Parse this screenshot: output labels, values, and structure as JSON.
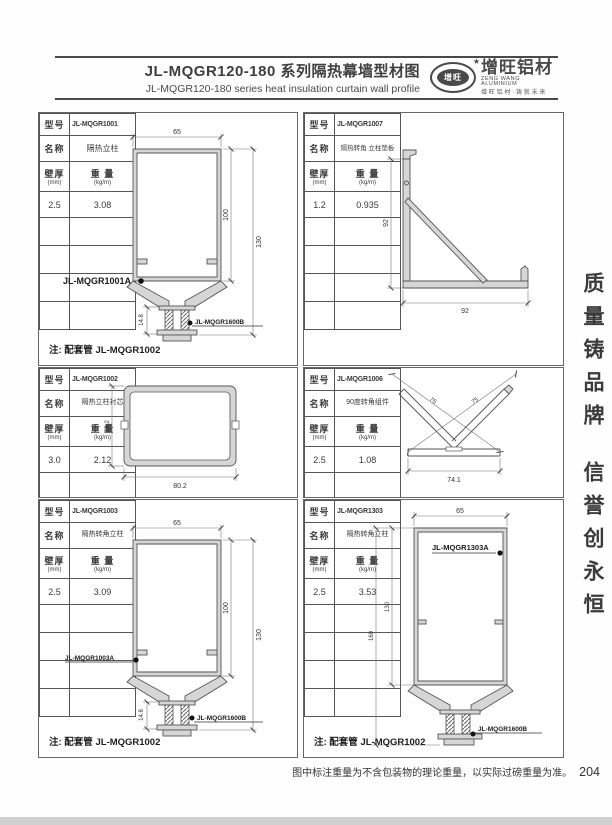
{
  "header": {
    "title_cn": "JL-MQGR120-180 系列隔热幕墙型材图",
    "title_en": "JL-MQGR120-180 series heat insulation curtain wall profile",
    "logo": {
      "badge_text": "增旺",
      "star": "★",
      "brand_cn": "增旺铝材",
      "brand_en": "ZENG WANG ALUMINIUM",
      "tagline": "增旺铝材·铸就未来"
    }
  },
  "table_labels": {
    "model": "型号",
    "name": "名称",
    "thickness": "壁厚",
    "thickness_unit": "(mm)",
    "weight": "重 量",
    "weight_unit": "(kg/m)"
  },
  "panels": [
    {
      "model": "JL-MQGR1001",
      "name": "隔热立柱",
      "thickness": "2.5",
      "weight": "3.08",
      "note": "注: 配套管 JL-MQGR1002",
      "labels": {
        "a": "JL-MQGR1001A",
        "b": "JL-MQGR1600B"
      },
      "dims": {
        "width": "65",
        "inner_height": "100",
        "outer_height": "130",
        "connector": "14.8"
      }
    },
    {
      "model": "JL-MQGR1007",
      "name": "隔热转角 立柱垫板",
      "thickness": "1.2",
      "weight": "0.935",
      "dims": {
        "height": "92",
        "width": "92"
      }
    },
    {
      "model": "JL-MQGR1002",
      "name": "隔热立柱衬芯",
      "thickness": "3.0",
      "weight": "2.12",
      "dims": {
        "height": "58.2",
        "width": "80.2"
      }
    },
    {
      "model": "JL-MQGR1006",
      "name": "90度转角组件",
      "thickness": "2.5",
      "weight": "1.08",
      "dims": {
        "diag_left": "75",
        "diag_right": "75",
        "width": "74.1"
      }
    },
    {
      "model": "JL-MQGR1003",
      "name": "隔热转角立柱",
      "thickness": "2.5",
      "weight": "3.09",
      "note": "注: 配套管 JL-MQGR1002",
      "labels": {
        "a": "JL-MQGR1003A",
        "b": "JL-MQGR1600B"
      },
      "dims": {
        "width": "65",
        "inner_height": "100",
        "outer_height": "130",
        "connector": "14.8"
      }
    },
    {
      "model": "JL-MQGR1303",
      "name": "隔热转角立柱",
      "thickness": "2.5",
      "weight": "3.53",
      "note": "注: 配套管 JL-MQGR1002",
      "labels": {
        "a": "JL-MQGR1303A",
        "b": "JL-MQGR1600B"
      },
      "dims": {
        "width": "65",
        "inner_height": "130",
        "outer_height": "160"
      }
    }
  ],
  "slogan": {
    "line1": "质量铸品牌",
    "line2": "信誉创永恒"
  },
  "footer": {
    "note": "图中标注重量为不含包装物的理论重量，以实际过磅重量为准。",
    "page": "204"
  }
}
